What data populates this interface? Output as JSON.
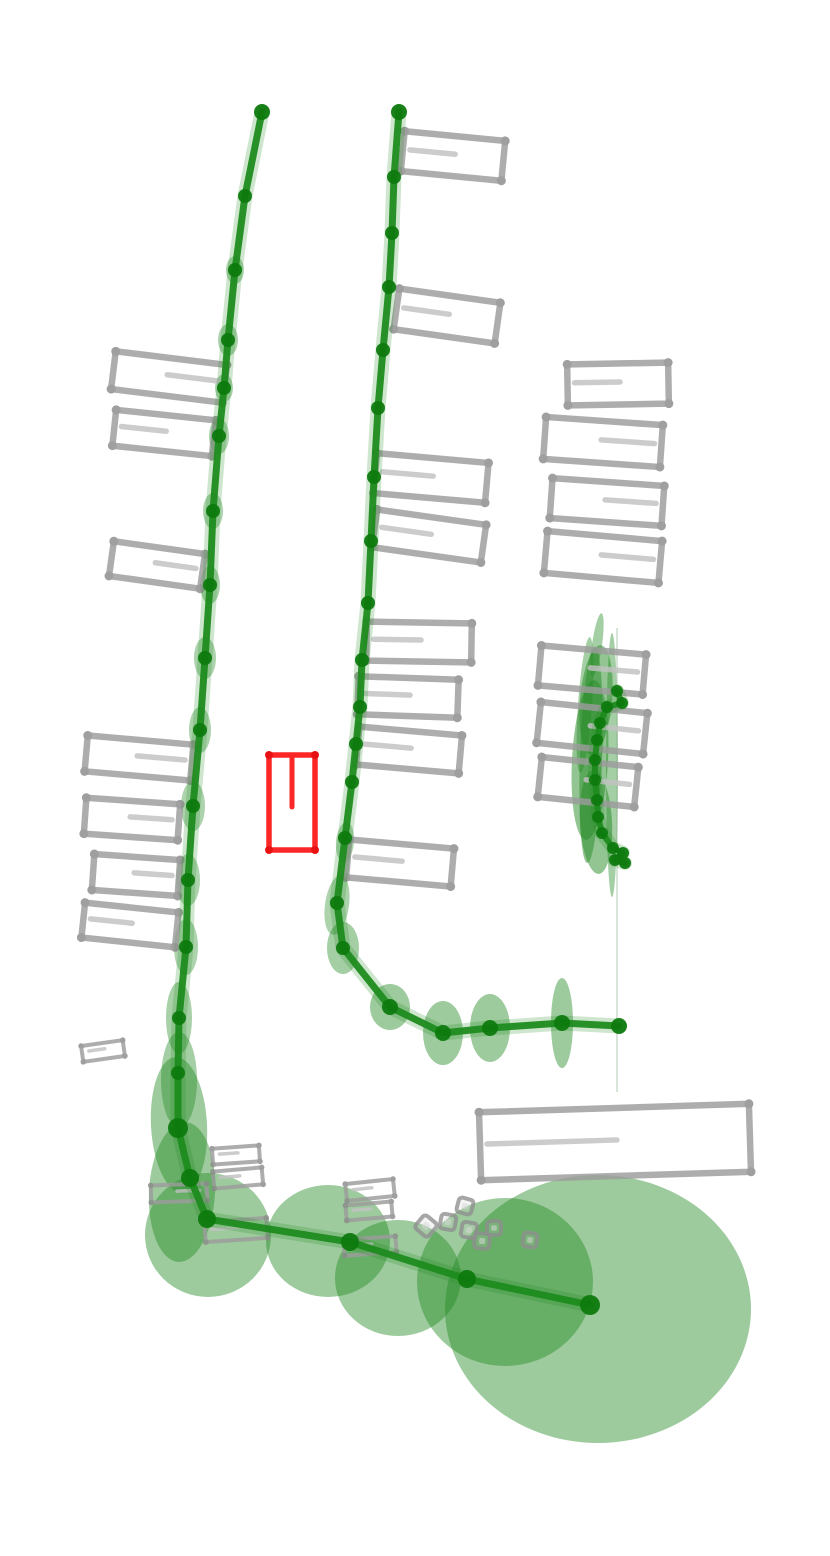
{
  "canvas": {
    "width": 830,
    "height": 1556
  },
  "colors": {
    "background": "#ffffff",
    "path_green": "#1e8b1e",
    "dot_green": "#0e7a0e",
    "ellipse_green": "#268b26",
    "vehicle_gray": "#9c9c9c",
    "vehicle_corner_gray": "#8a8a8a",
    "vehicle_heading_gray": "#c2c2c2",
    "pedestrian_gray": "#909090",
    "ego_red": "#fb1414",
    "ego_corner_red": "#e60000",
    "aux_line": "#8fb08f"
  },
  "uncertainty_ellipses": [
    [
      235,
      270,
      9,
      14,
      0,
      0.38
    ],
    [
      228,
      340,
      10,
      16,
      0,
      0.38
    ],
    [
      224,
      388,
      9,
      14,
      0,
      0.38
    ],
    [
      219,
      436,
      10,
      18,
      0,
      0.38
    ],
    [
      213,
      511,
      10,
      18,
      0,
      0.38
    ],
    [
      210,
      585,
      10,
      19,
      0,
      0.38
    ],
    [
      205,
      658,
      11,
      21,
      0,
      0.38
    ],
    [
      200,
      730,
      11,
      23,
      0,
      0.38
    ],
    [
      193,
      806,
      12,
      25,
      0,
      0.38
    ],
    [
      188,
      880,
      12,
      26,
      0,
      0.38
    ],
    [
      186,
      947,
      12,
      28,
      0,
      0.38
    ],
    [
      179,
      1018,
      13,
      36,
      0,
      0.4
    ],
    [
      179,
      1080,
      18,
      48,
      0,
      0.42
    ],
    [
      179,
      1125,
      28,
      68,
      -3,
      0.45
    ],
    [
      182,
      1192,
      33,
      70,
      3,
      0.45
    ],
    [
      208,
      1235,
      63,
      62,
      0,
      0.45
    ],
    [
      328,
      1241,
      62,
      56,
      0,
      0.45
    ],
    [
      398,
      1278,
      63,
      58,
      0,
      0.45
    ],
    [
      505,
      1282,
      88,
      84,
      0,
      0.45
    ],
    [
      598,
      1309,
      153,
      134,
      0,
      0.45
    ],
    [
      345,
      842,
      9,
      20,
      5,
      0.38
    ],
    [
      337,
      905,
      12,
      30,
      8,
      0.38
    ],
    [
      343,
      948,
      16,
      26,
      0,
      0.42
    ],
    [
      390,
      1007,
      20,
      23,
      0,
      0.45
    ],
    [
      443,
      1033,
      20,
      32,
      0,
      0.45
    ],
    [
      490,
      1028,
      20,
      34,
      0,
      0.45
    ],
    [
      562,
      1023,
      11,
      45,
      0,
      0.45
    ],
    [
      596,
      700,
      16,
      55,
      5,
      0.5
    ],
    [
      590,
      760,
      18,
      80,
      3,
      0.5
    ],
    [
      596,
      822,
      16,
      52,
      -3,
      0.5
    ],
    [
      585,
      705,
      7,
      68,
      4,
      0.42
    ],
    [
      612,
      765,
      6,
      132,
      0,
      0.42
    ],
    [
      597,
      645,
      5,
      32,
      8,
      0.42
    ],
    [
      591,
      755,
      11,
      108,
      2,
      0.5
    ]
  ],
  "aux_lines": [
    [
      617,
      628,
      617,
      1092,
      1.5
    ]
  ],
  "vehicles": [
    [
      453,
      156,
      101,
      40,
      5.5,
      -1
    ],
    [
      447,
      316,
      102,
      41,
      8,
      -1
    ],
    [
      169,
      377,
      112,
      38,
      7,
      1
    ],
    [
      164,
      433,
      100,
      36,
      6,
      -1
    ],
    [
      157,
      565,
      92,
      35,
      8,
      1
    ],
    [
      431,
      478,
      112,
      40,
      5,
      -1
    ],
    [
      429,
      536,
      110,
      38,
      8,
      -1
    ],
    [
      419,
      642,
      105,
      39,
      1,
      -1
    ],
    [
      408,
      697,
      100,
      38,
      2,
      -1
    ],
    [
      409,
      750,
      103,
      38,
      5,
      -1
    ],
    [
      400,
      863,
      105,
      38,
      5,
      -1
    ],
    [
      618,
      384,
      101,
      41,
      -1,
      -1
    ],
    [
      603,
      442,
      117,
      42,
      4,
      1
    ],
    [
      607,
      502,
      112,
      40,
      4,
      1
    ],
    [
      603,
      557,
      115,
      42,
      5,
      1
    ],
    [
      592,
      670,
      105,
      40,
      5,
      1
    ],
    [
      592,
      728,
      107,
      41,
      6,
      1
    ],
    [
      588,
      782,
      97,
      40,
      6,
      1
    ],
    [
      139,
      758,
      106,
      36,
      5,
      1
    ],
    [
      132,
      819,
      94,
      36,
      4,
      1
    ],
    [
      136,
      875,
      86,
      36,
      4,
      1
    ],
    [
      130,
      925,
      94,
      35,
      6,
      -1
    ],
    [
      103,
      1051,
      42,
      16,
      -8,
      -1
    ],
    [
      615,
      1142,
      270,
      68,
      -1.8,
      -1
    ],
    [
      236,
      1155,
      47,
      16,
      -4,
      -1
    ],
    [
      238,
      1178,
      49,
      17,
      -5,
      -1
    ],
    [
      179,
      1193,
      56,
      17,
      -2,
      1
    ],
    [
      236,
      1230,
      62,
      20,
      -4,
      -1
    ],
    [
      370,
      1190,
      48,
      17,
      -6,
      -1
    ],
    [
      369,
      1211,
      46,
      15,
      -5,
      -1
    ],
    [
      370,
      1246,
      52,
      16,
      -4,
      -1
    ]
  ],
  "pedestrians": [
    [
      426,
      1226,
      17,
      40
    ],
    [
      448,
      1222,
      15,
      10
    ],
    [
      465,
      1206,
      15,
      15
    ],
    [
      469,
      1230,
      15,
      10
    ],
    [
      482,
      1241,
      15,
      5
    ],
    [
      494,
      1228,
      14,
      0
    ],
    [
      530,
      1240,
      14,
      8
    ]
  ],
  "trajectories": [
    {
      "width": 7,
      "dot_r": 7,
      "points": [
        [
          262,
          112,
          8
        ],
        [
          245,
          196
        ],
        [
          235,
          270
        ],
        [
          228,
          340
        ],
        [
          224,
          388
        ],
        [
          219,
          436
        ],
        [
          213,
          511
        ],
        [
          210,
          585
        ],
        [
          205,
          658
        ],
        [
          200,
          730
        ],
        [
          193,
          806
        ],
        [
          188,
          880
        ],
        [
          186,
          947
        ],
        [
          179,
          1018
        ],
        [
          178,
          1073
        ],
        [
          178,
          1128,
          10
        ],
        [
          190,
          1178,
          9
        ],
        [
          207,
          1219,
          9
        ],
        [
          350,
          1242,
          9
        ],
        [
          467,
          1279,
          9
        ],
        [
          590,
          1305,
          10
        ]
      ]
    },
    {
      "width": 7,
      "dot_r": 7,
      "points": [
        [
          399,
          112,
          8
        ],
        [
          394,
          177
        ],
        [
          392,
          233
        ],
        [
          389,
          287
        ],
        [
          383,
          350
        ],
        [
          378,
          408
        ],
        [
          374,
          477
        ],
        [
          371,
          541
        ],
        [
          368,
          603
        ],
        [
          362,
          660
        ],
        [
          360,
          707
        ],
        [
          356,
          744
        ],
        [
          352,
          782
        ],
        [
          345,
          838
        ],
        [
          337,
          903
        ],
        [
          343,
          948
        ],
        [
          390,
          1007,
          8
        ],
        [
          443,
          1033,
          8
        ],
        [
          490,
          1028,
          8
        ],
        [
          562,
          1023,
          8
        ],
        [
          619,
          1026,
          8
        ]
      ]
    },
    {
      "width": 6,
      "dot_r": 6,
      "points": [
        [
          617,
          691
        ],
        [
          622,
          703
        ],
        [
          607,
          707
        ],
        [
          600,
          723
        ],
        [
          597,
          740
        ],
        [
          595,
          760
        ],
        [
          595,
          780
        ],
        [
          597,
          800
        ],
        [
          598,
          817
        ],
        [
          602,
          833
        ],
        [
          613,
          848
        ],
        [
          623,
          853
        ],
        [
          615,
          860
        ],
        [
          625,
          863
        ]
      ]
    }
  ],
  "ego_vehicle": {
    "x": 269,
    "y": 755,
    "width": 46,
    "height": 95,
    "heading_line": [
      23,
      1,
      23,
      52
    ],
    "stroke_width": 5.5
  }
}
